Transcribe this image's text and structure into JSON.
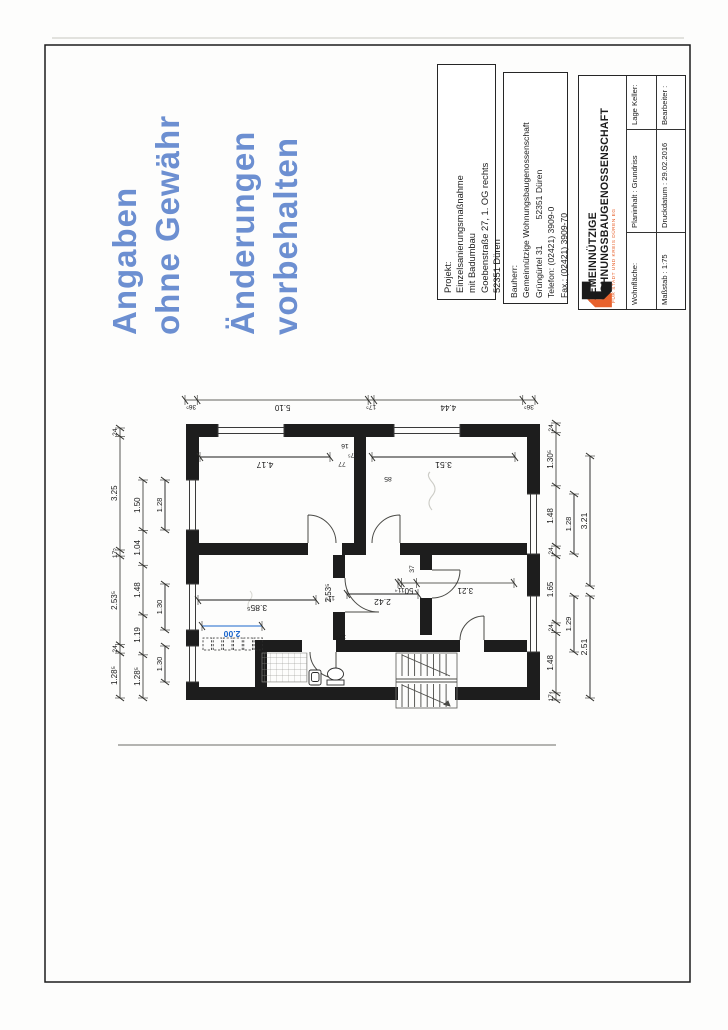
{
  "page": {
    "background": "#ffffff",
    "border_color": "#1c1c1c"
  },
  "stamp": {
    "color": "#4d78c8",
    "group1": [
      "Angaben",
      "ohne Gewähr"
    ],
    "group2": [
      "Änderungen",
      "vorbehalten"
    ]
  },
  "titleblock": {
    "projekt": {
      "label": "Projekt:",
      "lines": [
        "Einzelsanierungsmaßnahme",
        "mit Badumbau",
        "Goebenstraße 27, 1. OG rechts",
        "52351 Düren"
      ]
    },
    "bauherr": {
      "label": "Bauherr:",
      "line1": "Gemeinnützige Wohnungsbaugenossenschaft",
      "line2_left": "Grüngürtel 31",
      "line2_right": "52351 Düren",
      "line3": "Telefon: (02421) 3909-0",
      "line4": "Fax.: (02421) 3909-70"
    },
    "company": {
      "name_line1": "GEMEINNÜTZIGE",
      "name_line2": "WOHNUNGSBAUGENOSSENSCHAFT",
      "tagline": "FÜR STADT UND KREIS DÜREN EG",
      "logo_orange": "#e8622d",
      "logo_black": "#1a1a1a"
    },
    "info_table": {
      "row_top": [
        "Wohnfläche:",
        "Planinhalt :  Grundriss",
        "Lage Keller:"
      ],
      "row_bottom": [
        "Maßstab :  1:75",
        "Druckdatum :  29.02.2016",
        "Bearbeiter :"
      ]
    }
  },
  "plan": {
    "type": "floor-plan",
    "chains": {
      "facade": [
        "36⁵",
        "5.10",
        "17⁵",
        "4.44",
        "36⁵"
      ],
      "top_outer": [
        "1.28⁵",
        "24",
        "2.53⁵",
        "17⁵",
        "3.25",
        "24"
      ],
      "top_middle": [
        "1.28⁵",
        "1.19",
        "1.48",
        "1.04",
        "1.50"
      ],
      "top_windows": [
        "1.30",
        "1.30",
        "1.28"
      ],
      "bottom_inner": [
        "17⁴",
        "1.48",
        "24",
        "1.65",
        "24",
        "1.48",
        "1.30⁵",
        "24"
      ],
      "bottom_windows": [
        "1.29",
        "1.28"
      ],
      "bottom_outer": [
        "2.51",
        "3.21"
      ],
      "roomB_inner": [
        "11⁴",
        "50",
        "3.21"
      ]
    },
    "room_dims": {
      "room_right_top": "4.17",
      "room_right_bottom": "3.51",
      "room_left_top": "3.85⁵",
      "hall_depth": "2.42",
      "hall_width": "2.53⁵"
    },
    "small_dims": [
      "77",
      "17⁵",
      "16",
      "85",
      "11⁵",
      "37",
      "17⁵"
    ],
    "new_element": {
      "value": "2.00",
      "color": "#1b66cc"
    }
  }
}
